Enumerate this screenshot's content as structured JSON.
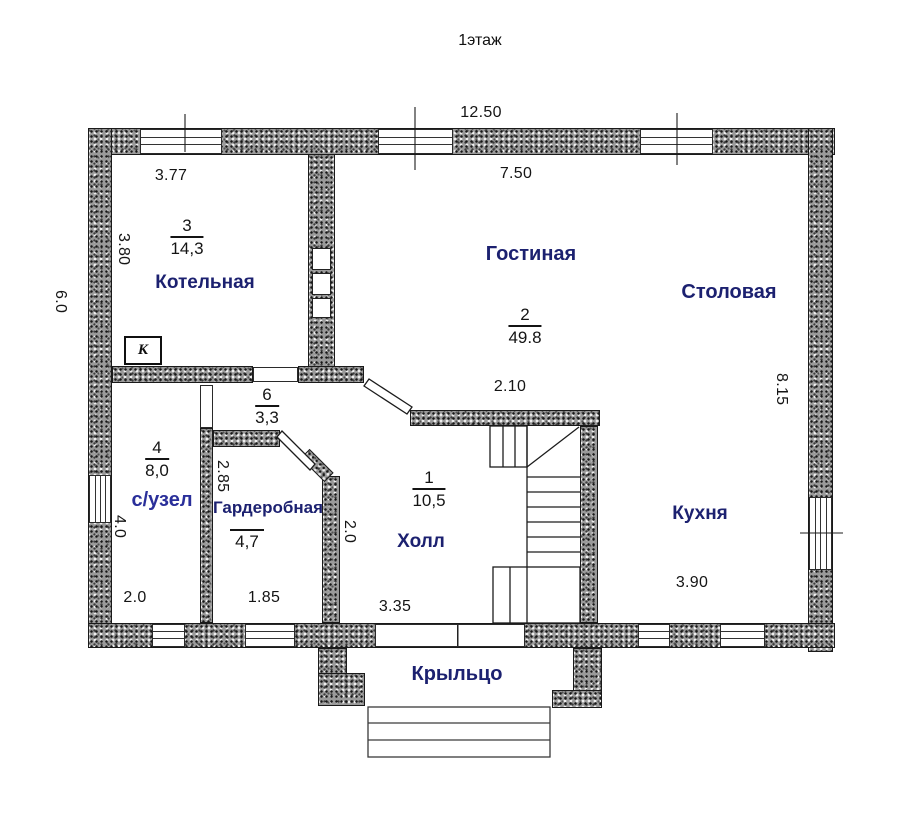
{
  "title": "1этаж",
  "colors": {
    "wall_speckle": "#9a9a9a",
    "room_label": "#1c2170",
    "dimension_text": "#151515",
    "line": "#1a1a1a"
  },
  "rooms": {
    "boiler": {
      "name": "Котельная",
      "number": "3",
      "area": "14,3"
    },
    "living": {
      "name": "Гостиная",
      "number": "2",
      "area": "49.8"
    },
    "dining": {
      "name": "Столовая"
    },
    "kitchen": {
      "name": "Кухня"
    },
    "bathroom": {
      "name": "с/узел",
      "number": "4",
      "area": "8,0"
    },
    "wardrobe": {
      "name": "Гардеробная",
      "area": "4,7"
    },
    "hall": {
      "name": "Холл",
      "number": "1",
      "area": "10,5"
    },
    "corridor": {
      "number": "6",
      "area": "3,3"
    },
    "porch": {
      "name": "Крыльцо"
    }
  },
  "dimensions": {
    "top_total": "12.50",
    "boiler_width": "3.77",
    "living_width": "7.50",
    "boiler_depth": "3.80",
    "left_side": "6.0",
    "right_side": "8.15",
    "stair_opening": "2.10",
    "wardrobe_depth": "2.85",
    "hall_passage": "2.0",
    "bathroom_depth": "4.0",
    "bathroom_width": "2.0",
    "wardrobe_width": "1.85",
    "hall_width": "3.35",
    "kitchen_width": "3.90"
  },
  "marks": {
    "boiler_unit": "К"
  }
}
